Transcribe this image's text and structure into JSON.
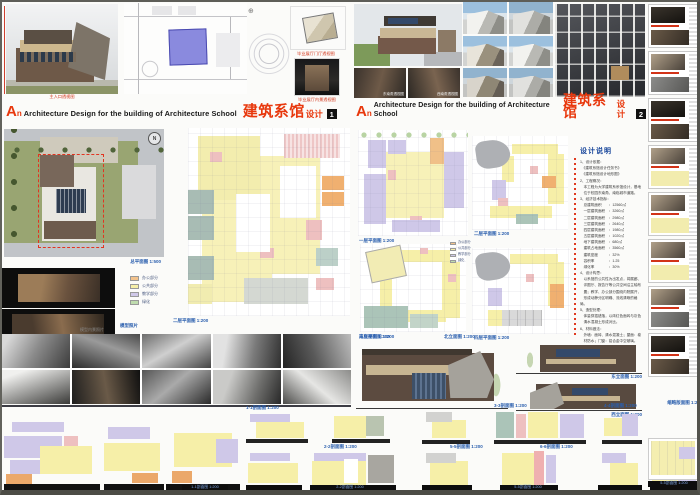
{
  "legend": {
    "items": [
      {
        "label": "办公部分",
        "color": "#f2c28c"
      },
      {
        "label": "公共部分",
        "color": "#f6efa8"
      },
      {
        "label": "教学部分",
        "color": "#cfc8e8"
      },
      {
        "label": "绿化",
        "color": "#bfdcae"
      }
    ]
  },
  "panel1": {
    "title": {
      "prefix": "A",
      "prefix_small": "n",
      "en": "Architecture Design for the building of Architecture School",
      "cn": "建筑系馆",
      "cn_sub": "设计",
      "num": "1"
    },
    "captions": {
      "hero": "主入口透视图",
      "thumb_a": "毕业展厅门厅透视图",
      "thumb_b": "毕业展厅内景透视图",
      "aerial": "总平面图 1:500",
      "model_photos": "模型照片",
      "main_plan": "二层平面图 1:200",
      "bw_photos": "模型内景照片"
    }
  },
  "panel2": {
    "title": {
      "prefix": "A",
      "prefix_small": "n",
      "en": "Architecture Design for the building of Architecture School",
      "cn": "建筑系馆",
      "cn_sub": "设计",
      "num": "2"
    },
    "captions": {
      "sub1": "东南角透视图",
      "sub2": "西南角透视图",
      "plan_a": "一层平面图 1:200",
      "plan_b": "三层平面图 1:200",
      "plan_c": "二层平面图 1:200",
      "plan_d": "四层平面图 1:200",
      "elev_1": "南立面图 1:200",
      "elev_2": "北立面图 1:200",
      "elev_3": "东立面图 1:200",
      "elev_4": "西立面图 1:200"
    },
    "notes": {
      "title": "设计说明",
      "body": "1、设计依据：\n　《建筑系馆设计任务书》\n　《建筑系馆设计地形图》\n2、工程概况：\n　本工程为大学建筑系系馆设计，基地\n　位于校园东南角，南临城市道路。\n3、经济技术指标：\n　总建筑面积　　：12560㎡\n　一层建筑面积　：3260㎡\n　二层建筑面积　：2980㎡\n　三层建筑面积　：2640㎡\n　四层建筑面积　：1980㎡\n　五层建筑面积　：1020㎡\n　地下建筑面积　：680㎡\n　建筑占地面积　：3560㎡\n　建筑密度　　　：32%\n　容积率　　　　：1.25\n　绿化率　　　　：30%\n4、设计构思：\n　以系馆的公共性为出发点，将展廊、\n　评图厅、报告厅等公共空间沿主轴布\n　置；教学、办公部分围绕内院展开，\n　形成动静分区明确、流线清晰的格局。\n5、造型处理：\n　体量穿插错落，以砖红色面砖与灰色\n　清水混凝土形成对比。\n6、材料做法：\n　外墙：面砖、清水混凝土；屋面：卷\n　材防水；门窗：铝合金中空玻璃。"
    }
  },
  "sections": {
    "captions": [
      "1-1剖面图 1:200",
      "2-2剖面图 1:200",
      "3-3剖面图 1:200",
      "4-4剖面图 1:200",
      "5-5剖面图 1:200",
      "6-6剖面图 1:200"
    ]
  },
  "sidebar": {
    "caption": "缩略版面图 1:25",
    "bottom_label": "5-5剖面图 1:200"
  }
}
